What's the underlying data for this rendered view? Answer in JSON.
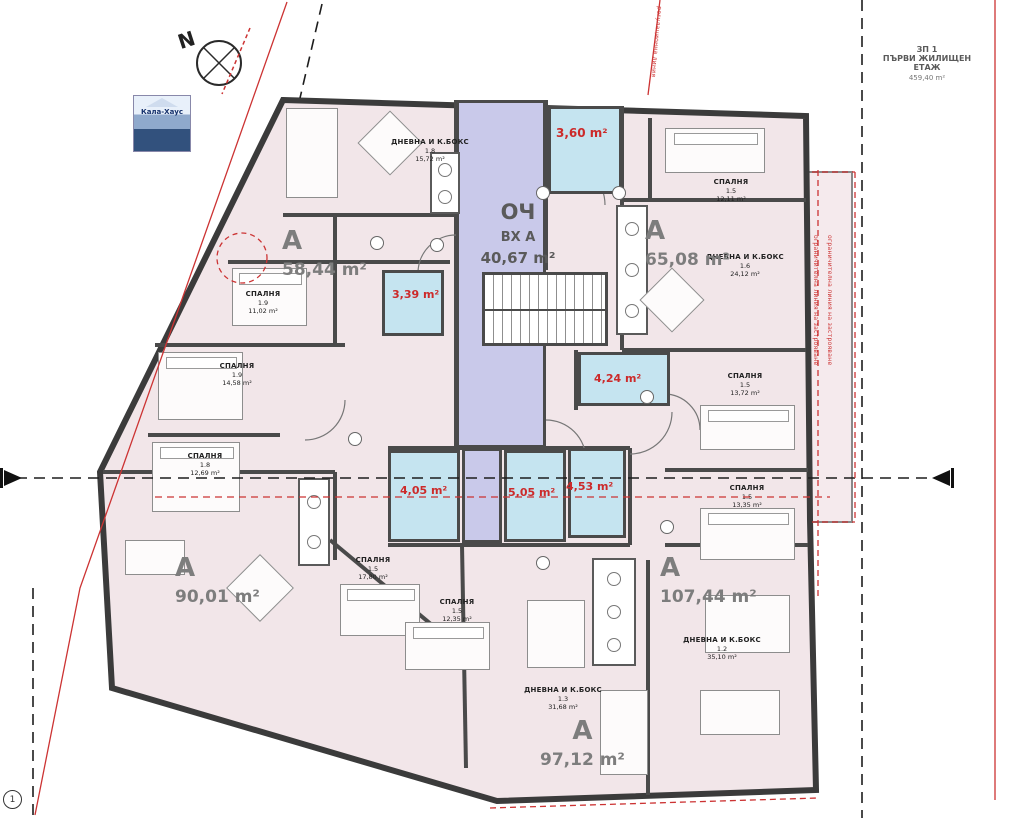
{
  "titleBlock": {
    "code": "ЗП 1",
    "line2": "ПЪРВИ ЖИЛИЩЕН",
    "line3": "ЕТАЖ",
    "area": "459,40 m²"
  },
  "compass": {
    "north": "N"
  },
  "logo": {
    "text": "Кала-Хаус"
  },
  "entrance": {
    "t1": "ОЧ",
    "t2": "ВХ А",
    "area": "40,67 m²"
  },
  "apartments": [
    {
      "letter": "А",
      "area": "58,44 m²"
    },
    {
      "letter": "А",
      "area": "65,08 m²"
    },
    {
      "letter": "А",
      "area": "90,01 m²"
    },
    {
      "letter": "А",
      "area": "107,44 m²"
    },
    {
      "letter": "А",
      "area": "97,12 m²"
    }
  ],
  "rooms": [
    {
      "name": "ДНЕВНА И К.БОКС",
      "num": "1.8",
      "area": "15,72 m²"
    },
    {
      "name": "СПАЛНЯ",
      "num": "1.9",
      "area": "11,02 m²"
    },
    {
      "name": "СПАЛНЯ",
      "num": "1.9",
      "area": "14,58 m²"
    },
    {
      "name": "СПАЛНЯ",
      "num": "1.8",
      "area": "12,69 m²"
    },
    {
      "name": "СПАЛНЯ",
      "num": "1.5",
      "area": "17,80 m²"
    },
    {
      "name": "СПАЛНЯ",
      "num": "1.5",
      "area": "12,35 m²"
    },
    {
      "name": "ДНЕВНА И К.БОКС",
      "num": "1.3",
      "area": "31,68 m²"
    },
    {
      "name": "ДНЕВНА И К.БОКС",
      "num": "1.2",
      "area": "35,10 m²"
    },
    {
      "name": "СПАЛНЯ",
      "num": "1.5",
      "area": "13,35 m²"
    },
    {
      "name": "СПАЛНЯ",
      "num": "1.5",
      "area": "13,72 m²"
    },
    {
      "name": "ДНЕВНА И К.БОКС",
      "num": "1.6",
      "area": "24,12 m²"
    },
    {
      "name": "СПАЛНЯ",
      "num": "1.5",
      "area": "12,11 m²"
    }
  ],
  "baths": [
    {
      "area": "3,60 m²"
    },
    {
      "area": "3,39 m²"
    },
    {
      "area": "4,24 m²"
    },
    {
      "area": "4,05 m²"
    },
    {
      "area": "5,05 m²"
    },
    {
      "area": "4,53 m²"
    }
  ],
  "annotations": {
    "red_note_right_1": "ограничителна линия на застрояване",
    "red_note_right_2": "ограничителна линия на застрояване",
    "red_note_top": "регулационна линия"
  },
  "gridMarker": {
    "label": "1"
  },
  "colors": {
    "wall": "#3f3f3f",
    "roomFill": "#f2e6e9",
    "corridor": "#c9c9ea",
    "bath": "#c5e4f0",
    "redLabel": "#cc2a2a",
    "redLine": "#cc3333"
  }
}
